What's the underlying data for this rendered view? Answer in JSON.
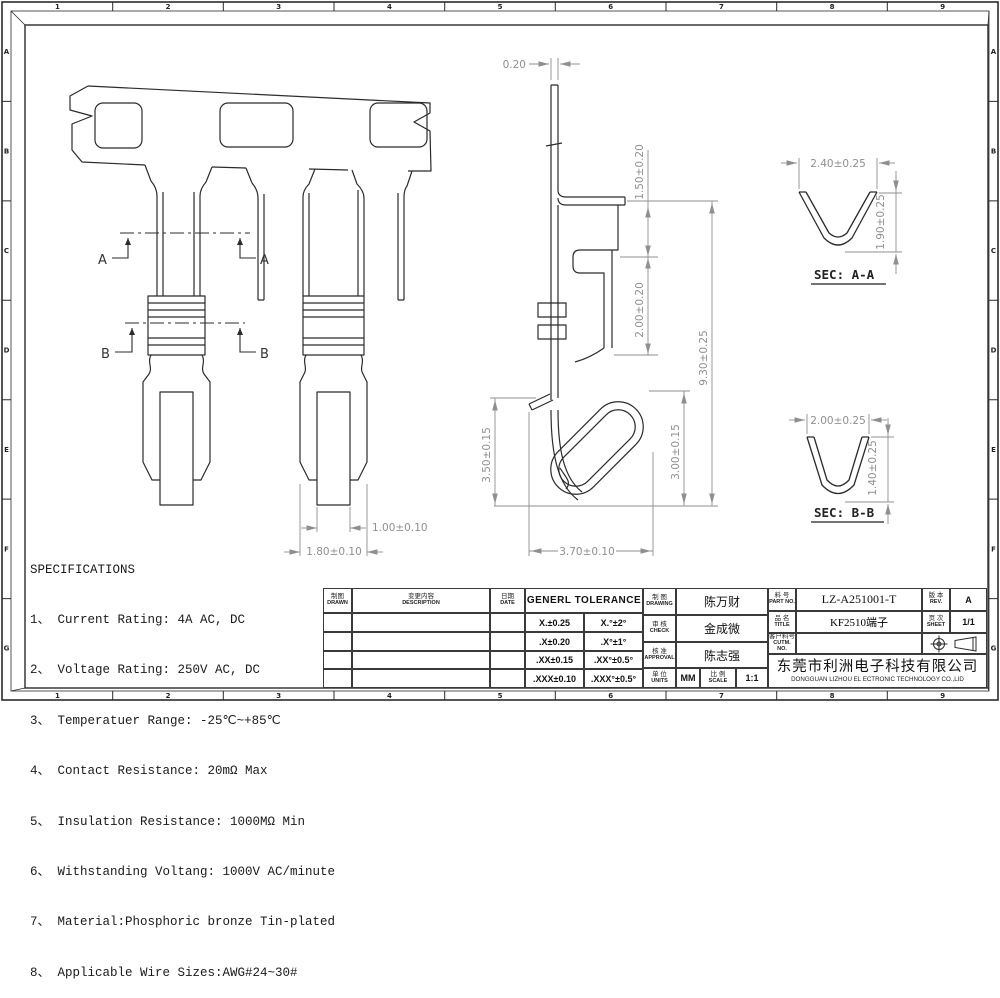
{
  "border": {
    "cols": [
      "1",
      "2",
      "3",
      "4",
      "5",
      "6",
      "7",
      "8",
      "9"
    ],
    "rows": [
      "A",
      "B",
      "C",
      "D",
      "E",
      "F",
      "G"
    ]
  },
  "colors": {
    "line": "#2b2b2b",
    "dim": "#8f8f8f"
  },
  "specifications": {
    "title": "SPECIFICATIONS",
    "lines": [
      "1、 Current Rating: 4A AC, DC",
      "2、 Voltage Rating: 250V AC, DC",
      "3、 Temperatuer Range: -25℃~+85℃",
      "4、 Contact Resistance: 20mΩ Max",
      "5、 Insulation Resistance: 1000MΩ Min",
      "6、 Withstanding Voltang: 1000V AC/minute",
      "7、 Material:Phosphoric bronze Tin-plated",
      "8、 Applicable Wire Sizes:AWG#24~30#"
    ]
  },
  "front_view": {
    "section_a_label": "A",
    "section_b_label": "B",
    "dim_inner": "1.00±0.10",
    "dim_outer": "1.80±0.10"
  },
  "side_view": {
    "dim_thickness": "0.20",
    "dim_step": "1.50±0.20",
    "dim_box": "2.00±0.20",
    "dim_total": "9.30±0.25",
    "dim_hook_left": "3.50±0.15",
    "dim_hook_right": "3.00±0.15",
    "dim_width": "3.70±0.10"
  },
  "section_aa": {
    "label": "SEC: A-A",
    "dim_width": "2.40±0.25",
    "dim_height": "1.90±0.25"
  },
  "section_bb": {
    "label": "SEC: B-B",
    "dim_width": "2.00±0.25",
    "dim_height": "1.40±0.25"
  },
  "title_block": {
    "rev_table": {
      "col1_cn": "制图",
      "col1_en": "DRAWN",
      "col2_cn": "变更内容",
      "col2_en": "DESCRIPTION",
      "col3_cn": "日期",
      "col3_en": "DATE"
    },
    "tolerance": {
      "header": "GENERL TOLERANCE",
      "rows": [
        [
          "X.±0.25",
          "X.°±2°"
        ],
        [
          ".X±0.20",
          ".X°±1°"
        ],
        [
          ".XX±0.15",
          ".XX°±0.5°"
        ],
        [
          ".XXX±0.10",
          ".XXX°±0.5°"
        ]
      ]
    },
    "drawing": {
      "label_cn": "制 图",
      "label_en": "DRAWING",
      "value": "陈万财"
    },
    "check": {
      "label_cn": "审 核",
      "label_en": "CHECK",
      "value": "金成微"
    },
    "approval": {
      "label_cn": "核 准",
      "label_en": "APPROVAL",
      "value": "陈志强"
    },
    "units": {
      "label_cn": "单 位",
      "label_en": "UNITS",
      "value": "MM"
    },
    "scale": {
      "label_cn": "比 例",
      "label_en": "SCALE",
      "value": "1:1"
    },
    "part_no": {
      "label_cn": "料 号",
      "label_en": "PART NO.",
      "value": "LZ-A251001-T"
    },
    "product": {
      "label_cn": "品 名",
      "label_en": "TITLE",
      "value": "KF2510端子"
    },
    "customer_no": {
      "label_cn": "客户料号",
      "label_en": "CUTM. NO.",
      "value": ""
    },
    "rev": {
      "label_cn": "版 本",
      "label_en": "REV.",
      "value": "A"
    },
    "sheet": {
      "label_cn": "页 次",
      "label_en": "SHEET",
      "value": "1/1"
    },
    "company_cn": "东莞市利洲电子科技有限公司",
    "company_en": "DONGGUAN LIZHOU EL ECTRONIC TECHNOLOGY CO.,LID"
  }
}
